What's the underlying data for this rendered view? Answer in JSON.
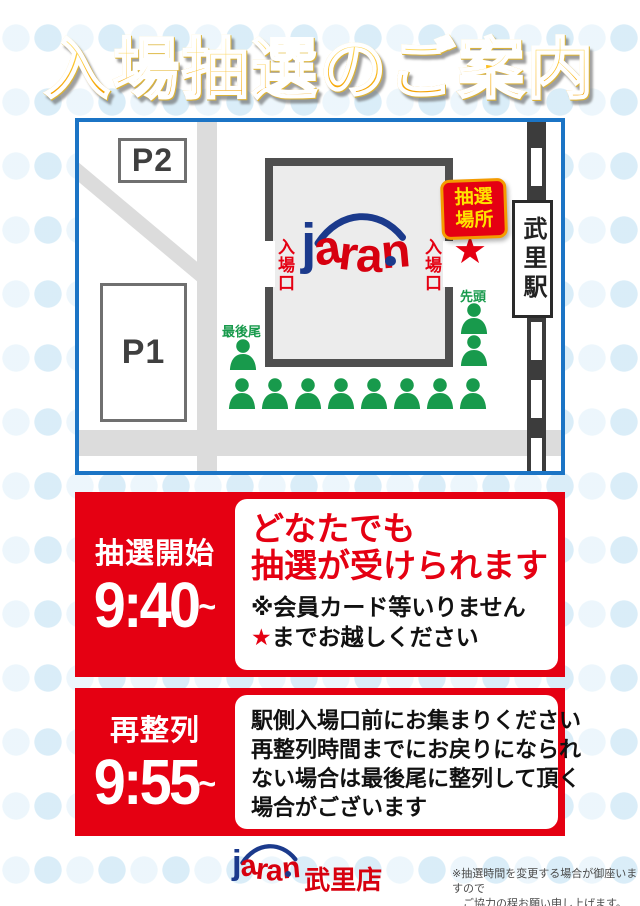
{
  "colors": {
    "red": "#e50012",
    "green": "#189a4c",
    "blue": "#1b74c5",
    "logoblue": "#1b3a8c",
    "logored": "#d7000f",
    "yellow": "#ffe100"
  },
  "title": "入場抽選のご案内",
  "map": {
    "p2": "P2",
    "p1": "P1",
    "entrance_left": "入場口",
    "entrance_right": "入場口",
    "lottery_place_line1": "抽選",
    "lottery_place_line2": "場所",
    "star": "★",
    "station": "武里駅",
    "queue_front_label": "先頭",
    "queue_back_label": "最後尾",
    "queue": {
      "right_count": 2,
      "bottom_count": 8,
      "back_count": 1
    },
    "logo": {
      "j": "j",
      "letters": [
        "a",
        "r",
        "a",
        "n"
      ]
    }
  },
  "panels": {
    "lottery_start": {
      "label": "抽選開始",
      "time": "9:40",
      "tilde": "~",
      "headline_line1": "どなたでも",
      "headline_line2": "抽選が受けられます",
      "note1": "※会員カード等いりません",
      "note2_star": "★",
      "note2": "までお越しください"
    },
    "relineup": {
      "label": "再整列",
      "time": "9:55",
      "tilde": "~",
      "line1": "駅側入場口前にお集まりください",
      "line2": "再整列時間までにお戻りになられ",
      "line3": "ない場合は最後尾に整列して頂く",
      "line4": "場合がございます"
    }
  },
  "footer": {
    "logo": {
      "j": "j",
      "letters": [
        "a",
        "r",
        "a",
        "n"
      ],
      "store": "武里店"
    },
    "note_line1": "※抽選時間を変更する場合が御座いますので",
    "note_line2": "ご協力の程お願い申し上げます。"
  }
}
